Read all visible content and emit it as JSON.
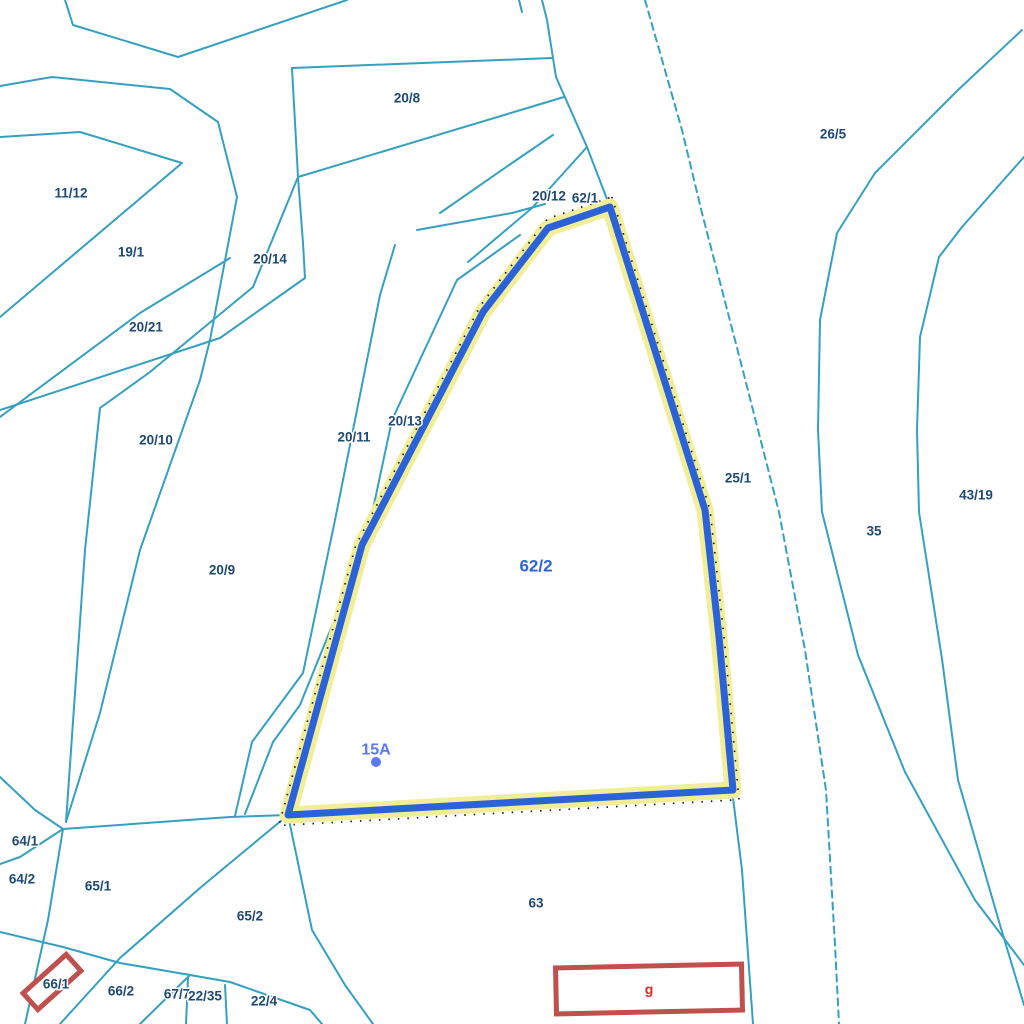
{
  "map": {
    "width": 1024,
    "height": 1024,
    "background": "#ffffff",
    "colors": {
      "boundary_line": "#35a0c2",
      "parcel_label": "#1e4976",
      "selected_parcel_label": "#2e64e0",
      "selected_outline": "#2b62d8",
      "selected_halo": "#f1ee97",
      "selected_dots": "#1a1a1a",
      "address_label": "#5b79f0",
      "building_outline": "#c0504d",
      "building_label": "#e02825"
    },
    "selected_parcel": {
      "id": "62/2",
      "label": {
        "text": "62/2",
        "x": 536,
        "y": 566
      },
      "polygon": "610,207 705,510 719,637 733,790 288,815 362,545 483,312 548,228",
      "address_point": {
        "text": "15A",
        "x": 376,
        "y": 750,
        "dot_x": 376,
        "dot_y": 762,
        "dot_r": 5
      }
    },
    "boundaries": [
      {
        "id": "top-left-zigzag",
        "points": "65,0 73,25 178,57 347,0",
        "dashed": false
      },
      {
        "id": "left-long-curve",
        "points": "0,86 52,77 170,89 218,122 237,197 210,340 200,380 140,550 100,713 66,822",
        "dashed": false
      },
      {
        "id": "wedge-11-12",
        "points": "0,137 80,132 182,163 0,317",
        "dashed": false
      },
      {
        "id": "sep-19-1",
        "points": "0,417 140,313 230,258",
        "dashed": false
      },
      {
        "id": "wedge-20-10-left",
        "points": "66,822 85,550 100,408 150,372 253,287 298,177",
        "dashed": false
      },
      {
        "id": "sep-20-21",
        "points": "305,278 220,338 0,410",
        "dashed": false
      },
      {
        "id": "p20-8-left",
        "points": "292,68 298,177 303,243 305,278",
        "dashed": false
      },
      {
        "id": "p20-8-top",
        "points": "292,68 552,58",
        "dashed": false
      },
      {
        "id": "p20-8-bottom",
        "points": "298,177 564,97",
        "dashed": false
      },
      {
        "id": "road-left",
        "points": "542,0 547,20 556,77 587,147 610,207",
        "dashed": false
      },
      {
        "id": "road-right",
        "points": "645,0 682,130 702,213 742,367 779,512 805,650 826,790 835,945 839,1024",
        "dashed": true
      },
      {
        "id": "p20-12-a",
        "points": "440,213 512,163 553,135",
        "dashed": false
      },
      {
        "id": "p20-12-b",
        "points": "417,230 512,213 545,204",
        "dashed": false
      },
      {
        "id": "p62-1-cross",
        "points": "468,262 532,208 587,147",
        "dashed": false
      },
      {
        "id": "strip-20-13",
        "points": "395,245 380,295 335,520 303,673 252,742 235,816",
        "dashed": false
      },
      {
        "id": "strip-20-13b",
        "points": "520,235 457,280 392,420 366,542 300,705 273,742 245,814",
        "dashed": false
      },
      {
        "id": "river-left-bank",
        "points": "1022,30 958,90 875,173 837,233 820,320 818,430 822,512 858,655 905,772 975,900 1024,965",
        "dashed": false
      },
      {
        "id": "river-right-bank",
        "points": "1024,157 962,227 939,257 920,337 917,430 919,512 942,659 958,780 1000,925 1024,1005",
        "dashed": false
      },
      {
        "id": "p63-right",
        "points": "732,790 742,870 753,1024",
        "dashed": false
      },
      {
        "id": "node-west",
        "points": "0,777 35,810 63,829",
        "dashed": false
      },
      {
        "id": "sep-64-1",
        "points": "63,829 20,857 0,864",
        "dashed": false
      },
      {
        "id": "sep-64-2",
        "points": "63,829 48,920 25,1024",
        "dashed": false
      },
      {
        "id": "sep-65-1-65-2",
        "points": "60,1024 120,958 200,888 288,815",
        "dashed": false
      },
      {
        "id": "strip-66-top",
        "points": "0,932 63,947 120,963 190,975 230,982 310,1010 322,1024",
        "dashed": false
      },
      {
        "id": "sep-65-2-63",
        "points": "288,815 312,930 345,985 373,1024",
        "dashed": false
      },
      {
        "id": "node-east",
        "points": "63,829 230,817 288,815",
        "dashed": false
      },
      {
        "id": "sep-66-2-67-7",
        "points": "190,975 140,1024",
        "dashed": false
      },
      {
        "id": "sep-67-7-22-35",
        "points": "188,978 186,1024",
        "dashed": false
      },
      {
        "id": "sep-22-35-22-4",
        "points": "225,985 227,1024",
        "dashed": false
      },
      {
        "id": "top-stub",
        "points": "519,0 522,12",
        "dashed": false
      }
    ],
    "parcel_labels": [
      {
        "text": "20/8",
        "x": 407,
        "y": 98
      },
      {
        "text": "26/5",
        "x": 833,
        "y": 134
      },
      {
        "text": "11/12",
        "x": 71,
        "y": 193
      },
      {
        "text": "19/1",
        "x": 131,
        "y": 252
      },
      {
        "text": "20/14",
        "x": 270,
        "y": 259
      },
      {
        "text": "20/21",
        "x": 146,
        "y": 327
      },
      {
        "text": "20/12",
        "x": 549,
        "y": 196
      },
      {
        "text": "62/1",
        "x": 585,
        "y": 198
      },
      {
        "text": "20/10",
        "x": 156,
        "y": 440
      },
      {
        "text": "20/11",
        "x": 354,
        "y": 437
      },
      {
        "text": "20/13",
        "x": 405,
        "y": 421
      },
      {
        "text": "25/1",
        "x": 738,
        "y": 478
      },
      {
        "text": "43/19",
        "x": 976,
        "y": 495
      },
      {
        "text": "35",
        "x": 874,
        "y": 531
      },
      {
        "text": "20/9",
        "x": 222,
        "y": 570
      },
      {
        "text": "63",
        "x": 536,
        "y": 903
      },
      {
        "text": "64/1",
        "x": 25,
        "y": 841
      },
      {
        "text": "64/2",
        "x": 22,
        "y": 879
      },
      {
        "text": "65/1",
        "x": 98,
        "y": 886
      },
      {
        "text": "65/2",
        "x": 250,
        "y": 916
      },
      {
        "text": "66/1",
        "x": 56,
        "y": 984
      },
      {
        "text": "66/2",
        "x": 121,
        "y": 991
      },
      {
        "text": "67/7",
        "x": 177,
        "y": 994
      },
      {
        "text": "22/35",
        "x": 205,
        "y": 996
      },
      {
        "text": "22/4",
        "x": 264,
        "y": 1001
      }
    ],
    "buildings": [
      {
        "id": "building-66-1",
        "cx": 52,
        "cy": 982,
        "w": 58,
        "h": 22,
        "rotation": -42,
        "label": ""
      },
      {
        "id": "building-g",
        "cx": 649,
        "cy": 989,
        "w": 186,
        "h": 46,
        "rotation": -1.2,
        "label": "g"
      }
    ]
  }
}
